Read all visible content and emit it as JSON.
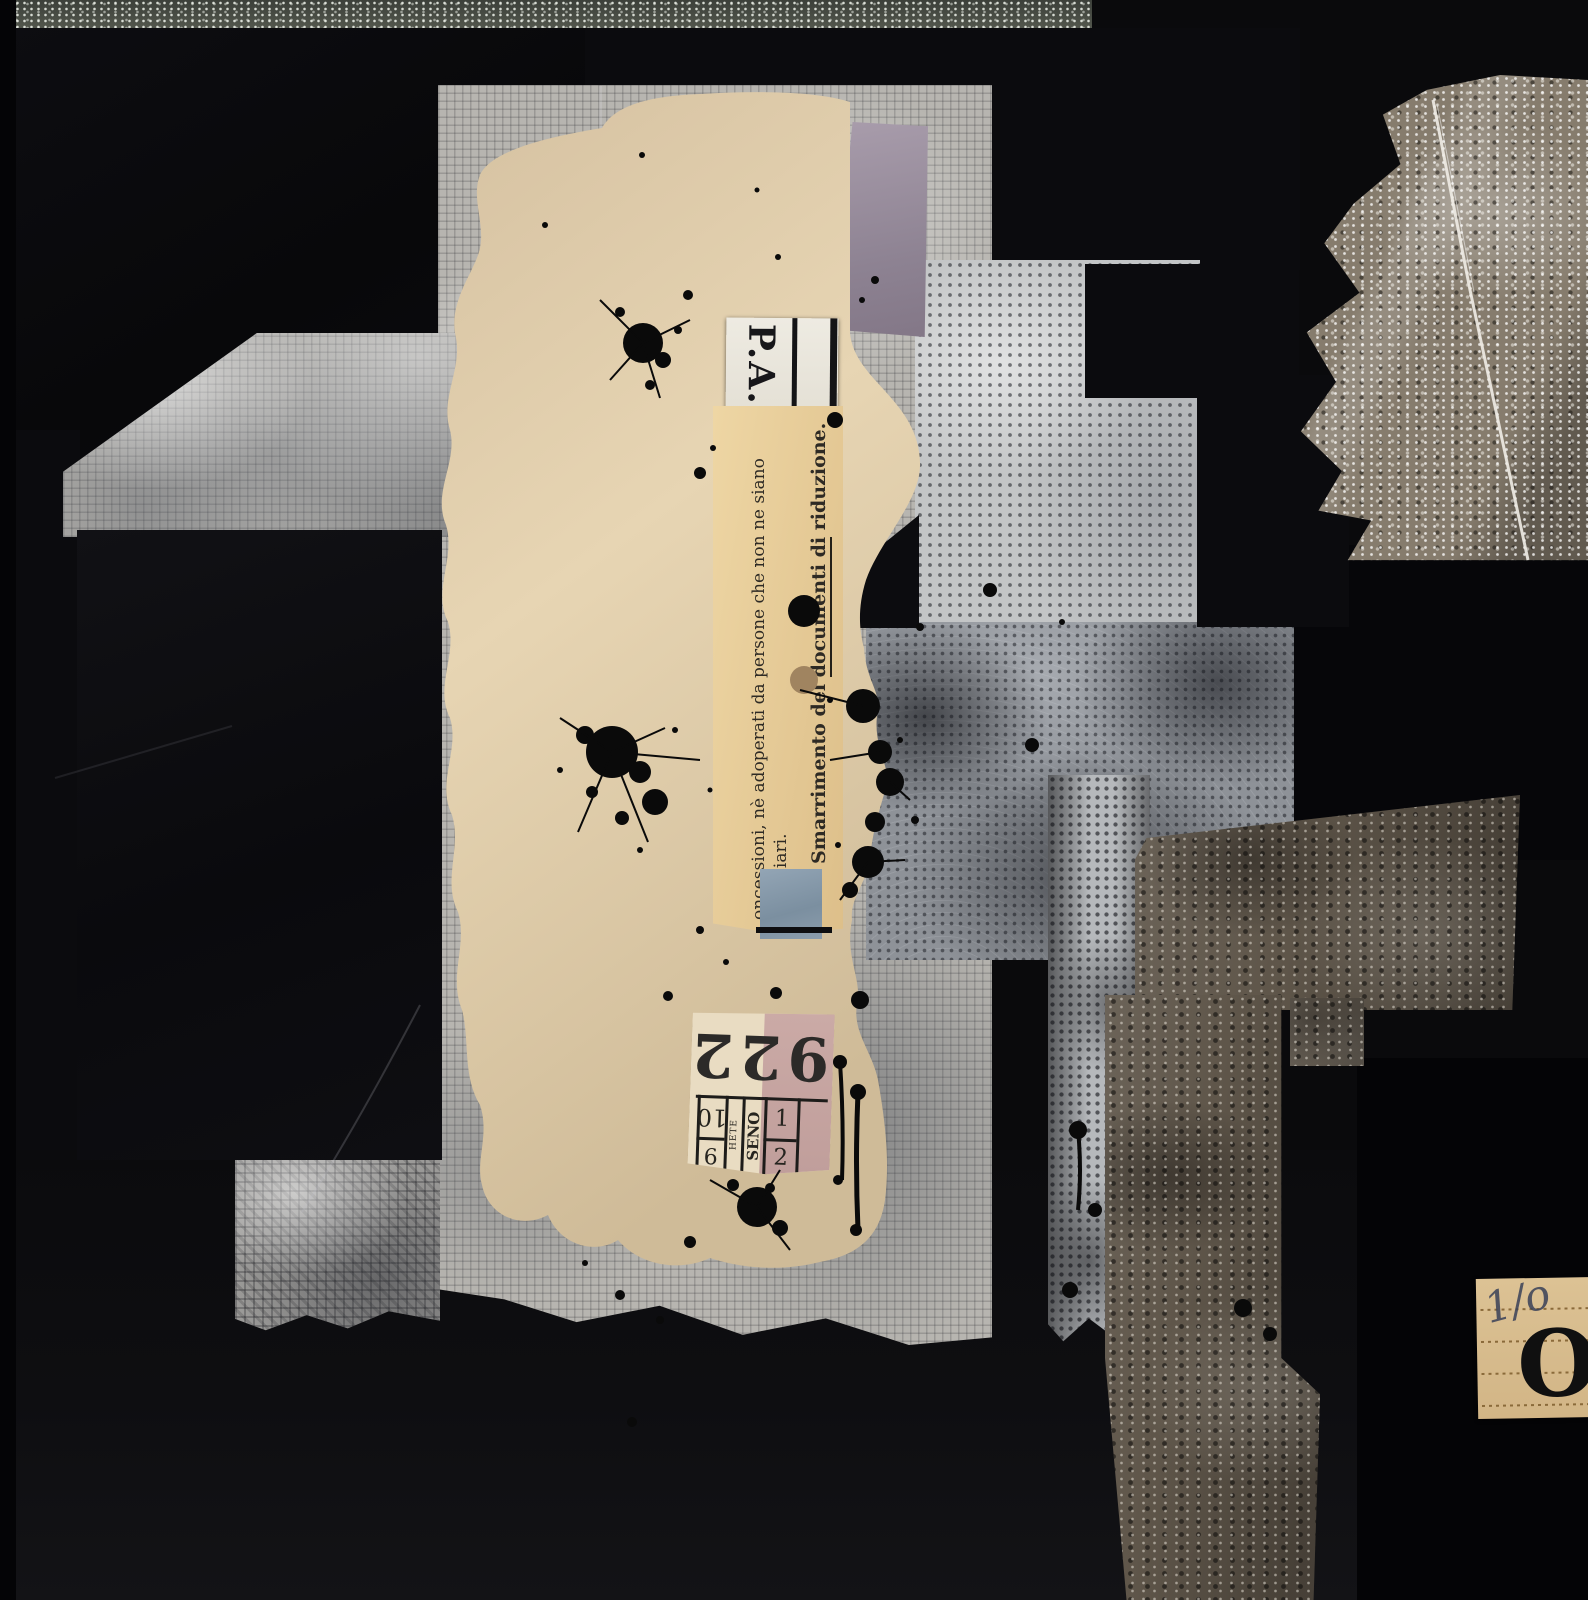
{
  "artwork": {
    "title": "untitled abstract collage",
    "medium": "mixed media collage with paper, ink and metal foil on black ground",
    "palette": {
      "background": "#0a0a0c",
      "paper_gray": "#b7b5b0",
      "paper_beige": "#e0cdab",
      "ticket_yellow": "#e9d09e",
      "ticket_white": "#ece9e0",
      "ticket_cream": "#e9dcc2",
      "ticket_pink": "#c7a6a2",
      "ticket_tan": "#d8bd90",
      "foil_silver": "#867c6d",
      "foil_bronze": "#5f564a",
      "patch_purple": "#9e93a0",
      "square_blue": "#8797a6",
      "ink": "#0b0b0b"
    },
    "texts": {
      "pa_ticket": {
        "label": "P.A."
      },
      "italian_strip": {
        "line1": "oncessioni, nè adoperati da persone che non ne siano",
        "line2": "eneficiari.",
        "line3_lead": "Smarrimento del ",
        "line3_underlined": "documenti di",
        "line3_tail": " riduzione."
      },
      "ticket_922": {
        "number": "922",
        "cell_top": "10",
        "cell_bottom": "9",
        "col_small": "HETE",
        "col_seno": "SENO",
        "pink_top": "1",
        "pink_bottom": "2"
      },
      "o_ticket": {
        "handwritten": "1/o",
        "letter": "O"
      }
    }
  }
}
